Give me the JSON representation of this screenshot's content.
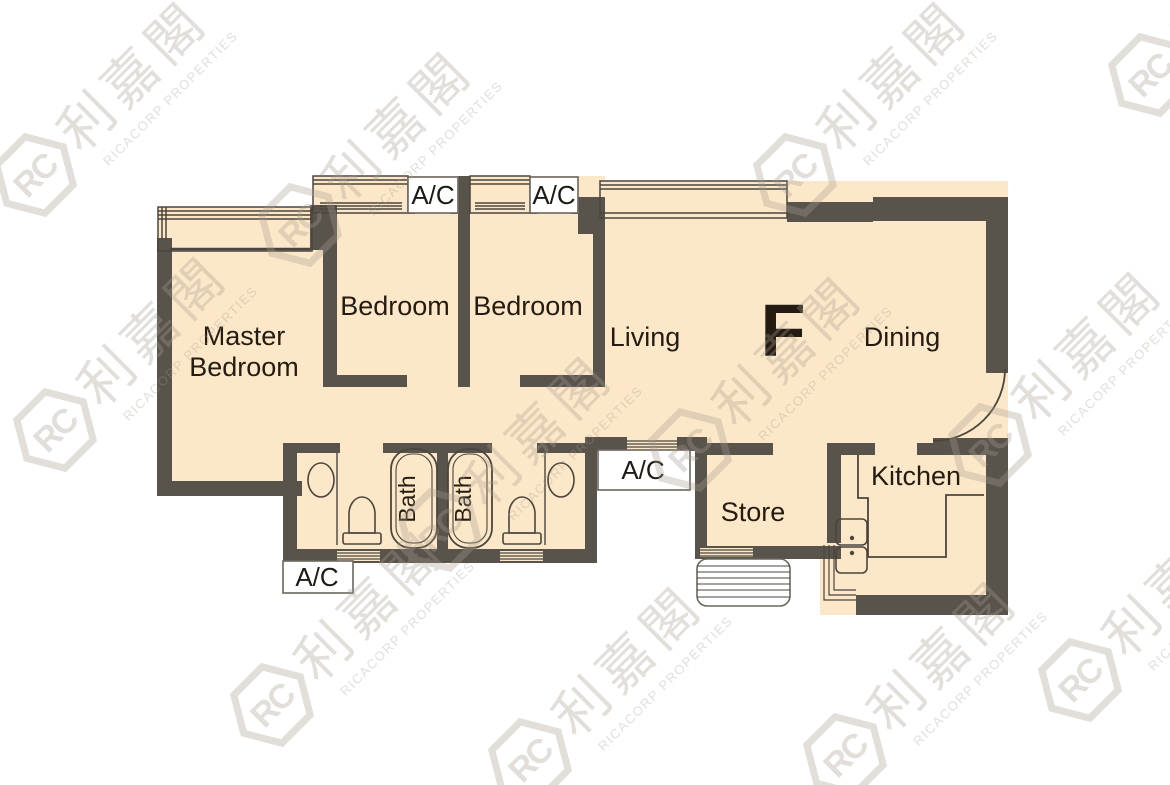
{
  "colors": {
    "floor": "#FCE8C8",
    "wall": "#58534B",
    "fixture_line": "#4A453E",
    "label_text": "#241C12",
    "watermark": "#A89D8F",
    "background": "#FFFFFF"
  },
  "rooms": {
    "master_line1": "Master",
    "master_line2": "Bedroom",
    "bedroom1": "Bedroom",
    "bedroom2": "Bedroom",
    "living": "Living",
    "flat_letter": "F",
    "dining": "Dining",
    "kitchen": "Kitchen",
    "store": "Store",
    "bath1": "Bath",
    "bath2": "Bath"
  },
  "ac": {
    "top1": "A/C",
    "top2": "A/C",
    "bottom_left": "A/C",
    "center": "A/C"
  },
  "watermark": {
    "logo": "RC",
    "chinese": "利嘉閣",
    "english": "RICACORP PROPERTIES"
  }
}
